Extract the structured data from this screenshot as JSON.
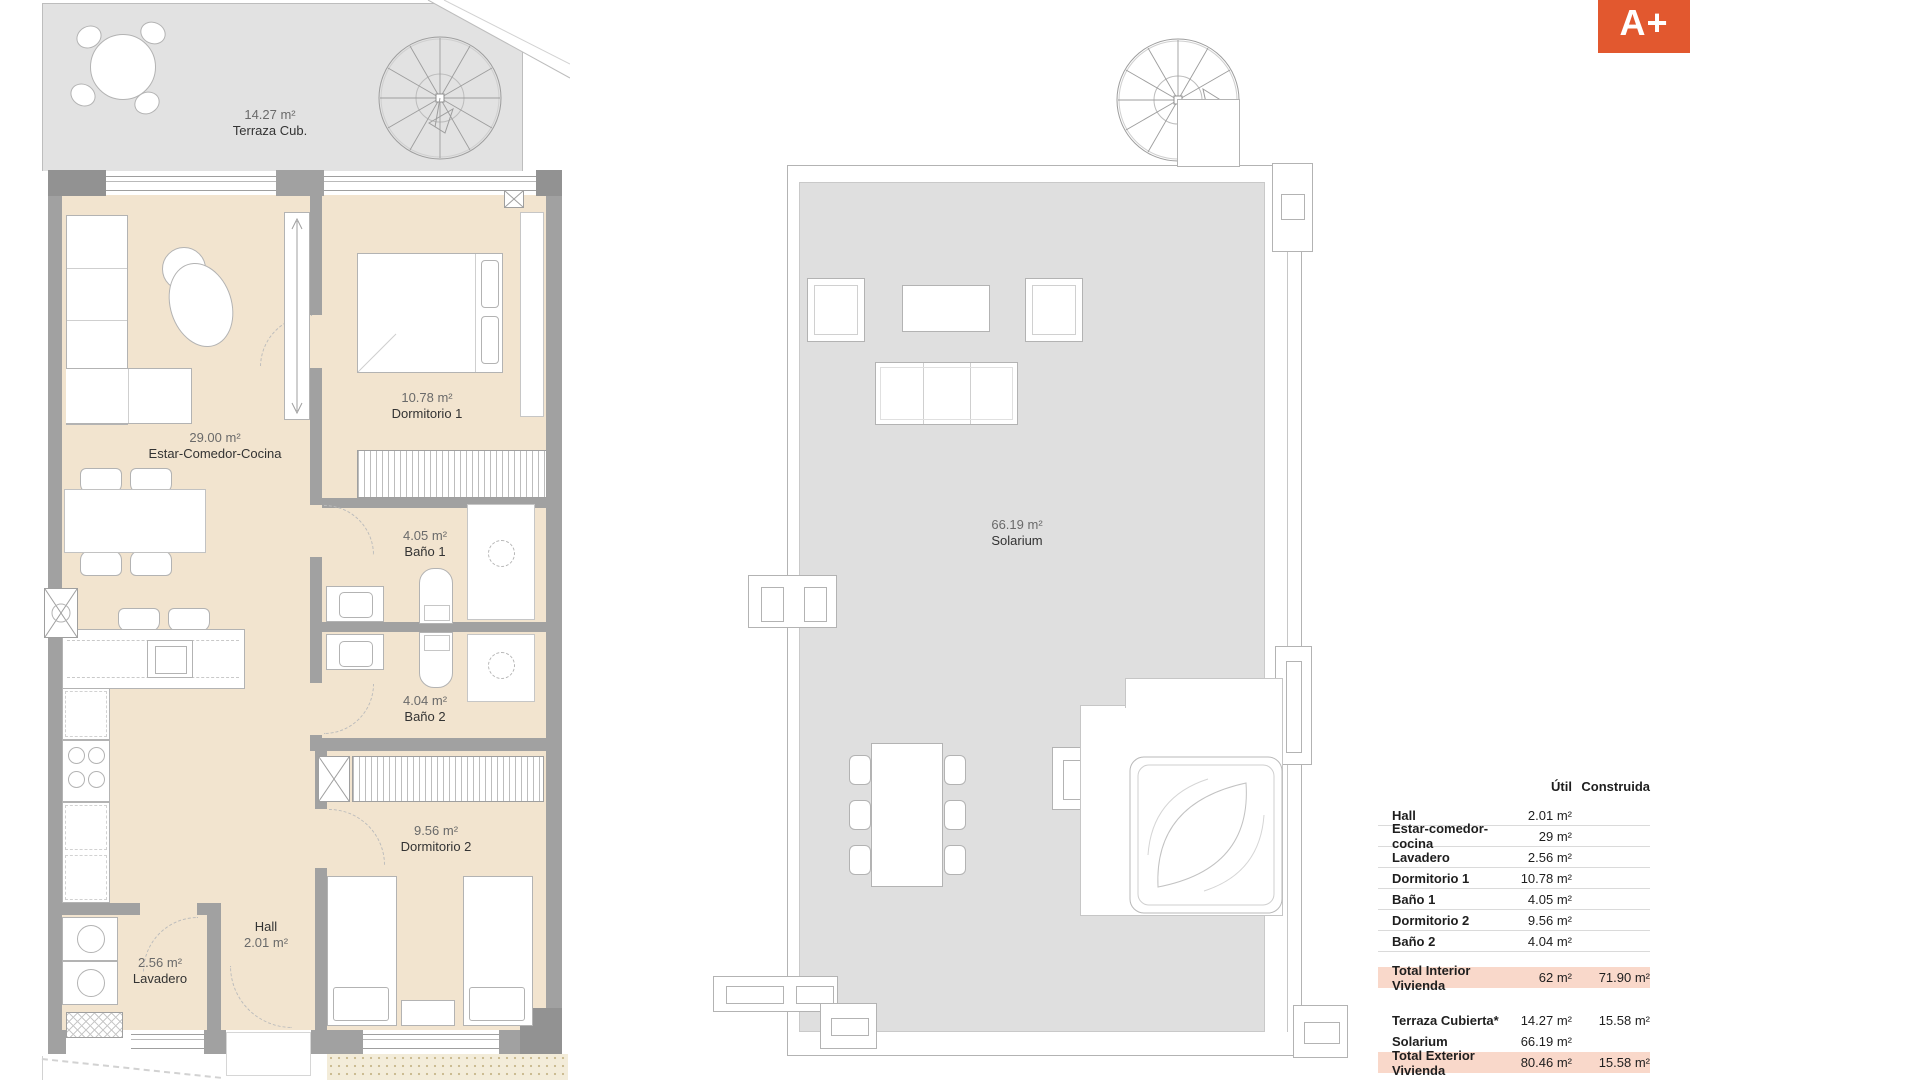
{
  "badge": {
    "label": "A+"
  },
  "colors": {
    "badge_background": "#e2582f",
    "table_highlight": "#f9d8ca",
    "interior_fill": "#f2e4cf",
    "terrace_fill": "#e2e2e2",
    "solarium_fill": "#dfdfdf",
    "wall": "#a1a1a1"
  },
  "plans": {
    "main": {
      "terrace": {
        "area": "14.27 m²",
        "name": "Terraza Cub."
      },
      "living": {
        "area": "29.00 m²",
        "name": "Estar-Comedor-Cocina"
      },
      "bedroom1": {
        "area": "10.78 m²",
        "name": "Dormitorio 1"
      },
      "bath1": {
        "area": "4.05 m²",
        "name": "Baño 1"
      },
      "bath2": {
        "area": "4.04 m²",
        "name": "Baño 2"
      },
      "bedroom2": {
        "area": "9.56 m²",
        "name": "Dormitorio 2"
      },
      "hall": {
        "name": "Hall",
        "area": "2.01 m²"
      },
      "laundry": {
        "area": "2.56 m²",
        "name": "Lavadero"
      }
    },
    "roof": {
      "solarium": {
        "area": "66.19 m²",
        "name": "Solarium"
      }
    }
  },
  "table": {
    "col_util": "Útil",
    "col_construida": "Construida",
    "rows": [
      {
        "label": "Hall",
        "util": "2.01 m²",
        "construida": ""
      },
      {
        "label": "Estar-comedor-cocina",
        "util": "29 m²",
        "construida": ""
      },
      {
        "label": "Lavadero",
        "util": "2.56 m²",
        "construida": ""
      },
      {
        "label": "Dormitorio 1",
        "util": "10.78 m²",
        "construida": ""
      },
      {
        "label": "Baño 1",
        "util": "4.05 m²",
        "construida": ""
      },
      {
        "label": "Dormitorio 2",
        "util": "9.56 m²",
        "construida": ""
      },
      {
        "label": "Baño 2",
        "util": "4.04 m²",
        "construida": ""
      },
      {
        "label": "Total Interior Vivienda",
        "util": "62 m²",
        "construida": "71.90 m²"
      },
      {
        "label": "Terraza Cubierta*",
        "util": "14.27 m²",
        "construida": "15.58 m²"
      },
      {
        "label": "Solarium",
        "util": "66.19 m²",
        "construida": ""
      },
      {
        "label": "Total Exterior Vivienda",
        "util": "80.46 m²",
        "construida": "15.58 m²"
      }
    ]
  }
}
